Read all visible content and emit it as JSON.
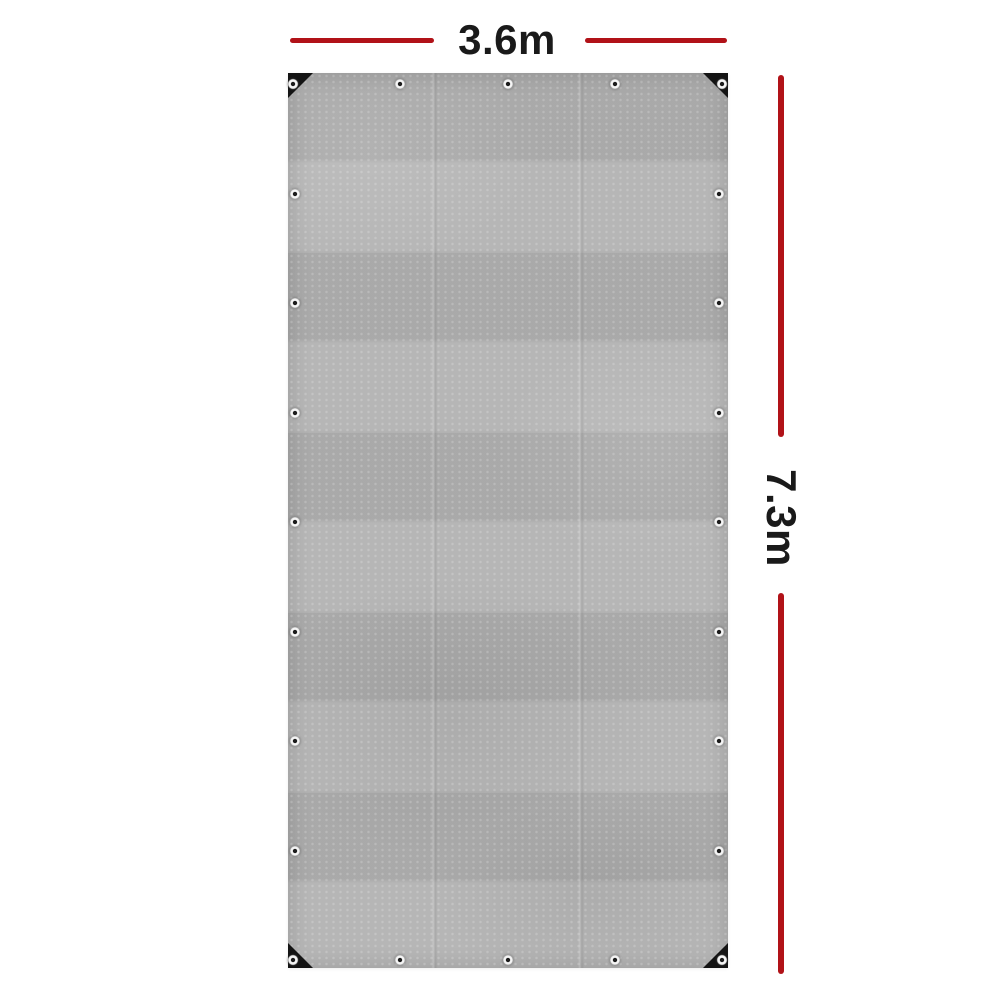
{
  "scene": {
    "type": "product-photo",
    "subject": "grey tarpaulin with black reinforced corners and metal eyelets"
  },
  "annotations": {
    "width": {
      "label": "3.6m"
    },
    "height": {
      "label": "7.3m"
    }
  },
  "tarp": {
    "eyelets": {
      "top": 5,
      "bottom": 5,
      "left": 9,
      "right": 9,
      "total_visible": 24
    },
    "corner_patches": 4
  },
  "colors": {
    "background": "#ffffff",
    "dimension_line_red": "#b11218",
    "label_text": "#1a1a1a",
    "tarp_grey": "#b1b1b1",
    "corner_patch_black": "#141414",
    "eyelet_ring_white": "#f5f5f5"
  }
}
